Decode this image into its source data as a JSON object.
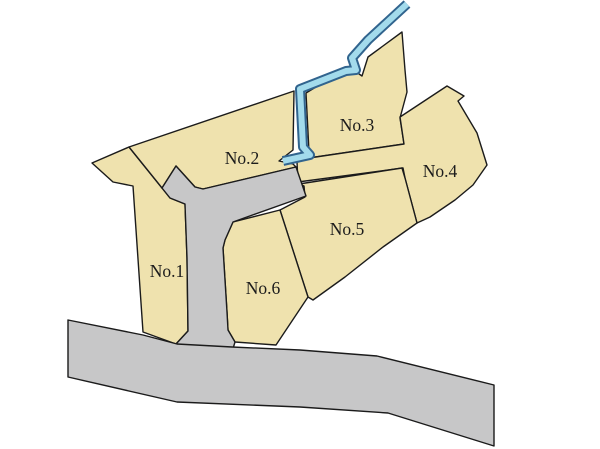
{
  "colors": {
    "background": "#ffffff",
    "parcel_fill": "#efe2ae",
    "outline": "#1b1b1b",
    "road_fill": "#c7c7c8",
    "water_fill": "#a3dbec",
    "water_outline": "#31648e",
    "label": "#1c1c1c"
  },
  "parcels": [
    {
      "label": "No.1"
    },
    {
      "label": "No.2"
    },
    {
      "label": "No.3"
    },
    {
      "label": "No.4"
    },
    {
      "label": "No.5"
    },
    {
      "label": "No.6"
    }
  ]
}
